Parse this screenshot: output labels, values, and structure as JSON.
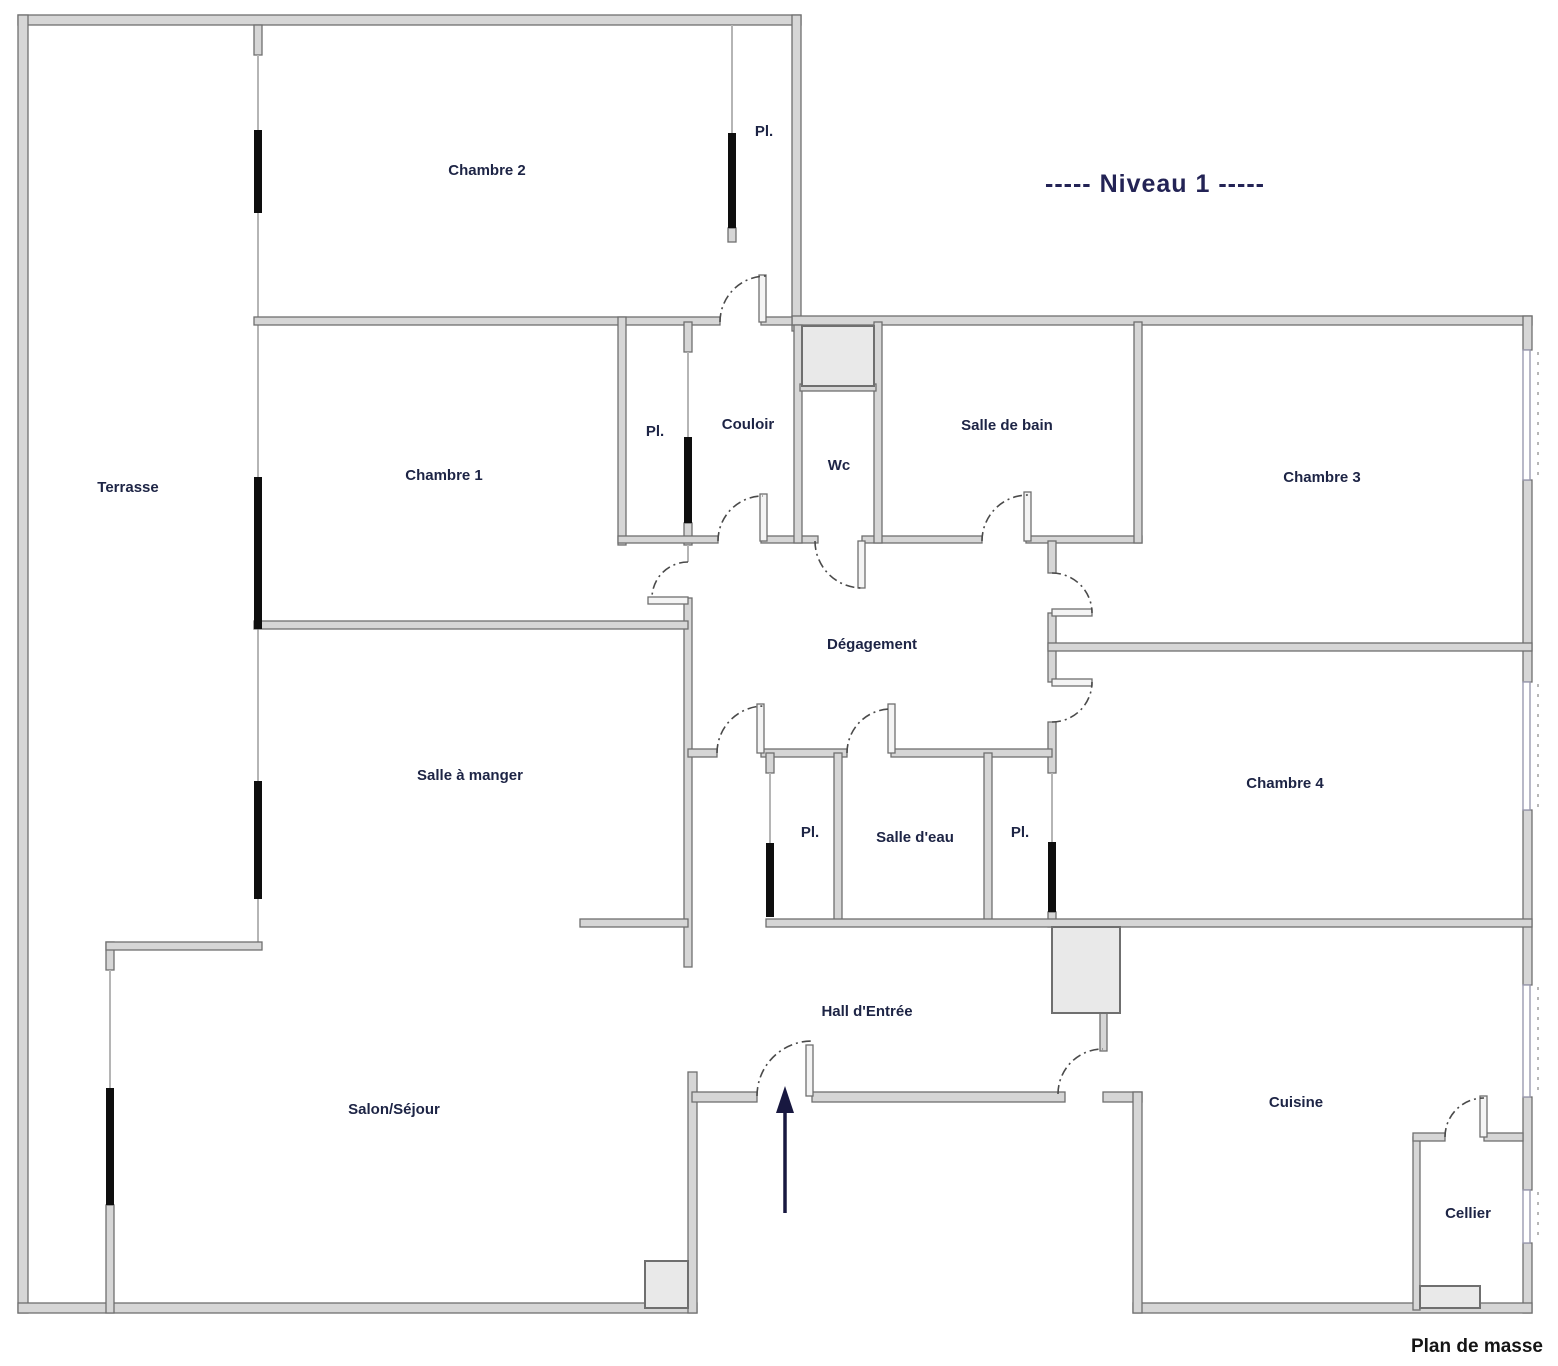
{
  "title": "-----  Niveau 1  -----",
  "footer_label": "Plan de masse",
  "rooms": [
    {
      "id": "terrasse",
      "label": "Terrasse"
    },
    {
      "id": "chambre-2",
      "label": "Chambre 2"
    },
    {
      "id": "placard-chambre-2",
      "label": "Pl."
    },
    {
      "id": "chambre-1",
      "label": "Chambre 1"
    },
    {
      "id": "placard-couloir",
      "label": "Pl."
    },
    {
      "id": "couloir",
      "label": "Couloir"
    },
    {
      "id": "wc",
      "label": "Wc"
    },
    {
      "id": "salle-de-bain",
      "label": "Salle de bain"
    },
    {
      "id": "chambre-3",
      "label": "Chambre 3"
    },
    {
      "id": "degagement",
      "label": "Dégagement"
    },
    {
      "id": "salle-a-manger",
      "label": "Salle à manger"
    },
    {
      "id": "chambre-4",
      "label": "Chambre 4"
    },
    {
      "id": "placard-gauche",
      "label": "Pl."
    },
    {
      "id": "salle-d-eau",
      "label": "Salle d'eau"
    },
    {
      "id": "placard-droit",
      "label": "Pl."
    },
    {
      "id": "hall-entree",
      "label": "Hall d'Entrée"
    },
    {
      "id": "salon-sejour",
      "label": "Salon/Séjour"
    },
    {
      "id": "cuisine",
      "label": "Cuisine"
    },
    {
      "id": "cellier",
      "label": "Cellier"
    }
  ],
  "colors": {
    "wall_fill": "#d6d6d6",
    "wall_stroke": "#6f6f6f",
    "structural_bar": "#0e0e0e",
    "label_text": "#1d2445",
    "title_text": "#232355",
    "footer_text": "#151515",
    "entrance_arrow": "#181840",
    "shaft_fill": "#e9e9e9",
    "background": "#ffffff"
  }
}
